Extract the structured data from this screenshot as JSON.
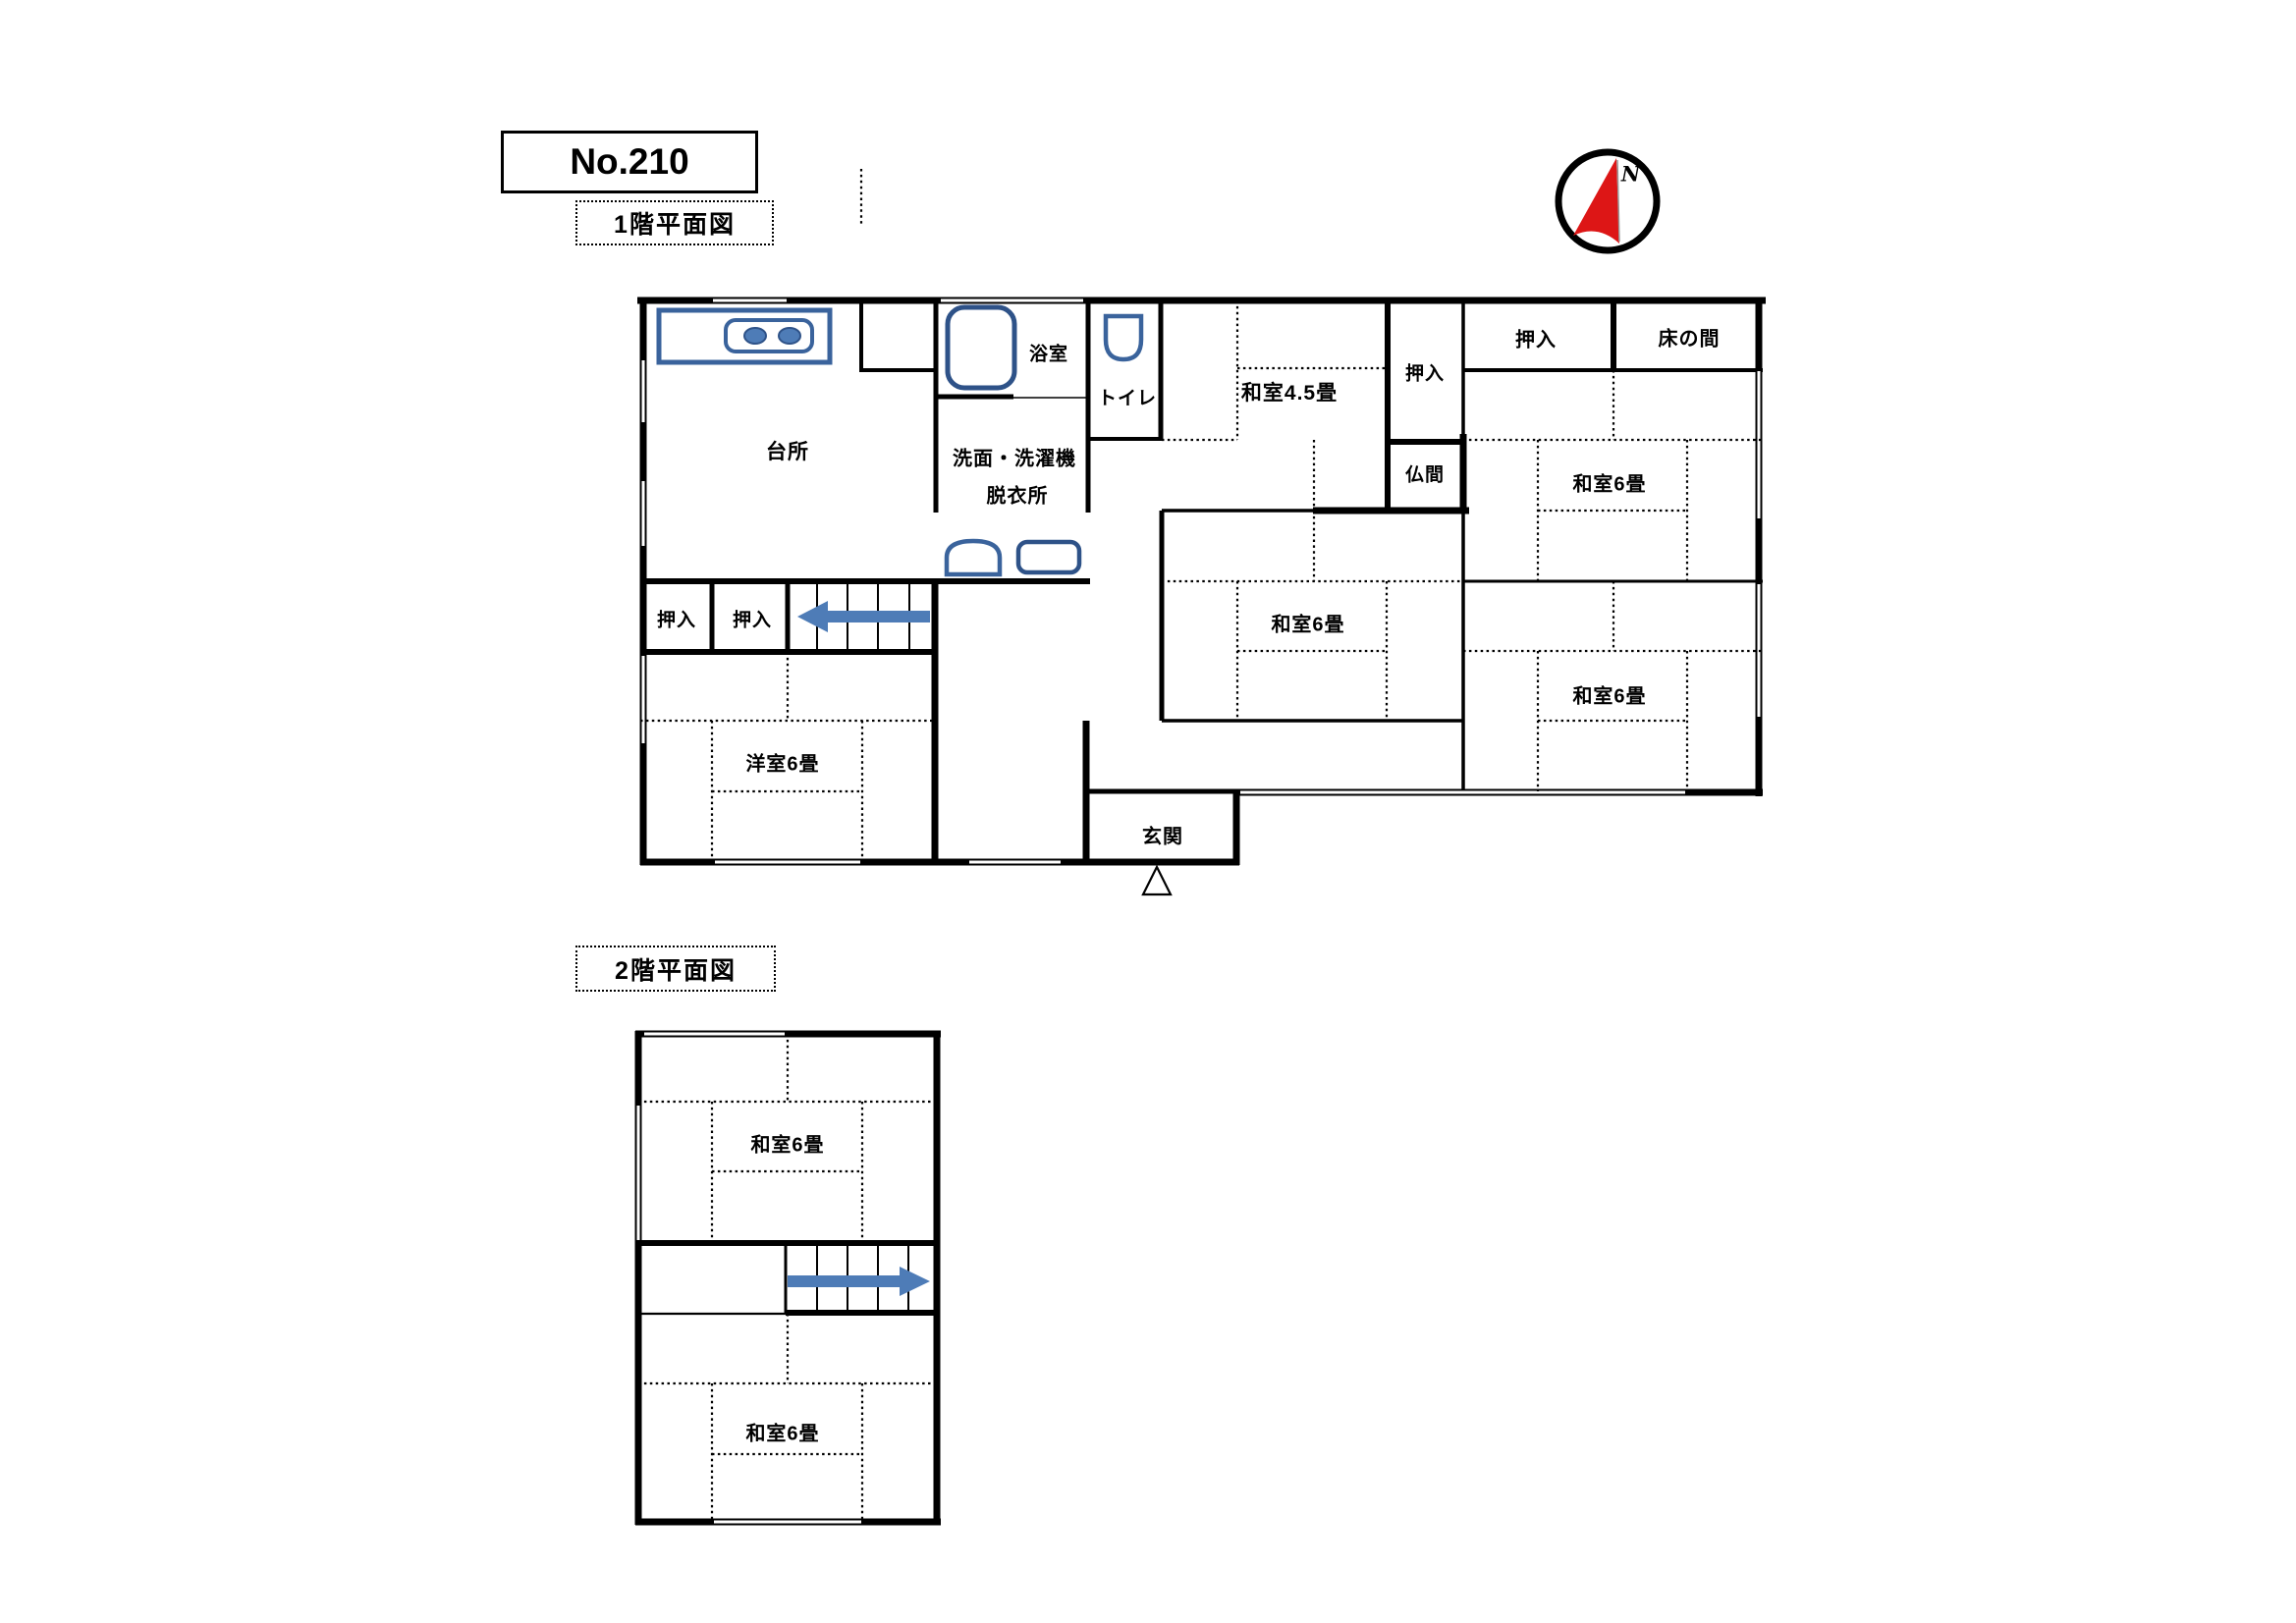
{
  "title": "No.210",
  "compass": {
    "north": "N"
  },
  "floor1": {
    "caption": "1階平面図",
    "rooms": {
      "kitchen": "台所",
      "bathroom": "浴室",
      "toilet": "トイレ",
      "washroom_line1": "洗面・洗濯機",
      "washroom_line2": "脱衣所",
      "washitsu_45": "和室4.5畳",
      "oshiire_center": "押入",
      "butsuma": "仏間",
      "oshiire_ne": "押入",
      "tokonoma": "床の間",
      "washitsu6_east_mid": "和室6畳",
      "washitsu6_center": "和室6畳",
      "washitsu6_east_south": "和室6畳",
      "oshiire_west1": "押入",
      "oshiire_west2": "押入",
      "yoshitsu6": "洋室6畳",
      "genkan": "玄関"
    }
  },
  "floor2": {
    "caption": "2階平面図",
    "rooms": {
      "washitsu6_north": "和室6畳",
      "washitsu6_south": "和室6畳"
    }
  }
}
